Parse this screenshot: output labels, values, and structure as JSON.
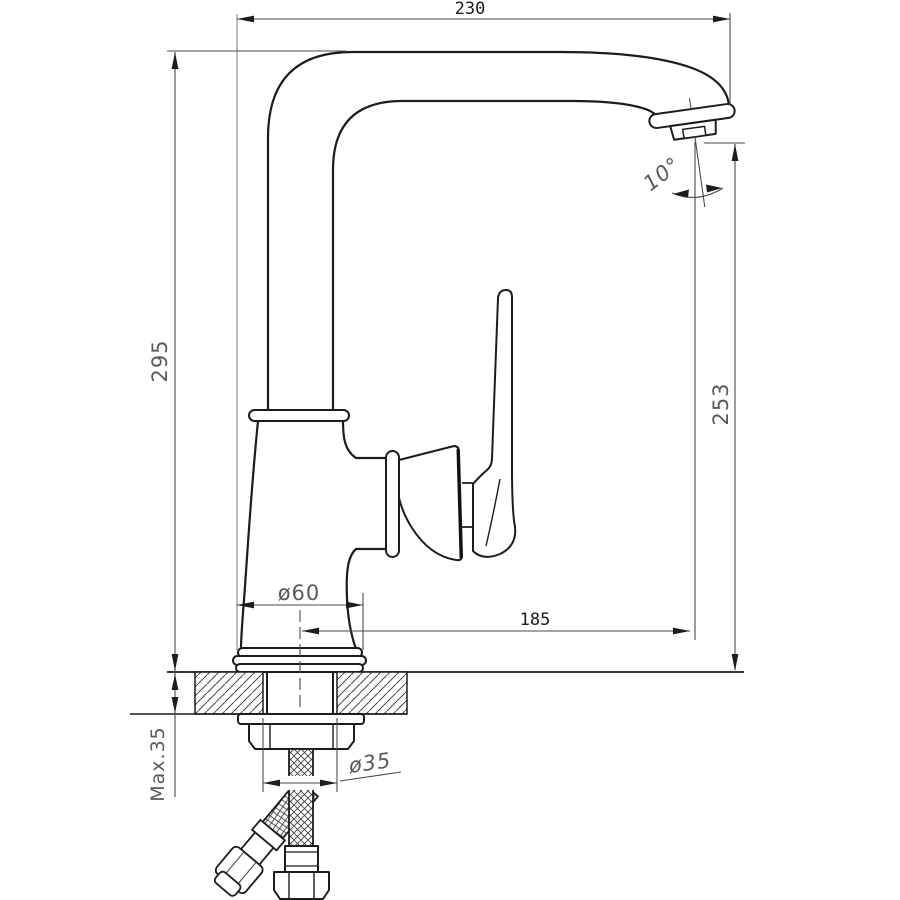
{
  "drawing": {
    "labels": {
      "spout_width": "230",
      "total_height": "295",
      "outlet_height": "253",
      "spout_reach": "185",
      "base_diameter": "ø60",
      "hole_diameter": "ø35",
      "max_counter": "Max.35",
      "outlet_angle": "10°"
    },
    "colors": {
      "outline": "#1c1c1c",
      "dimension_line": "#4a4a4a",
      "light_extension_line": "#8f8f8f",
      "dimension_text": "#5a5a5a",
      "measure_text": "#1a1a1a",
      "background": "#ffffff"
    }
  }
}
